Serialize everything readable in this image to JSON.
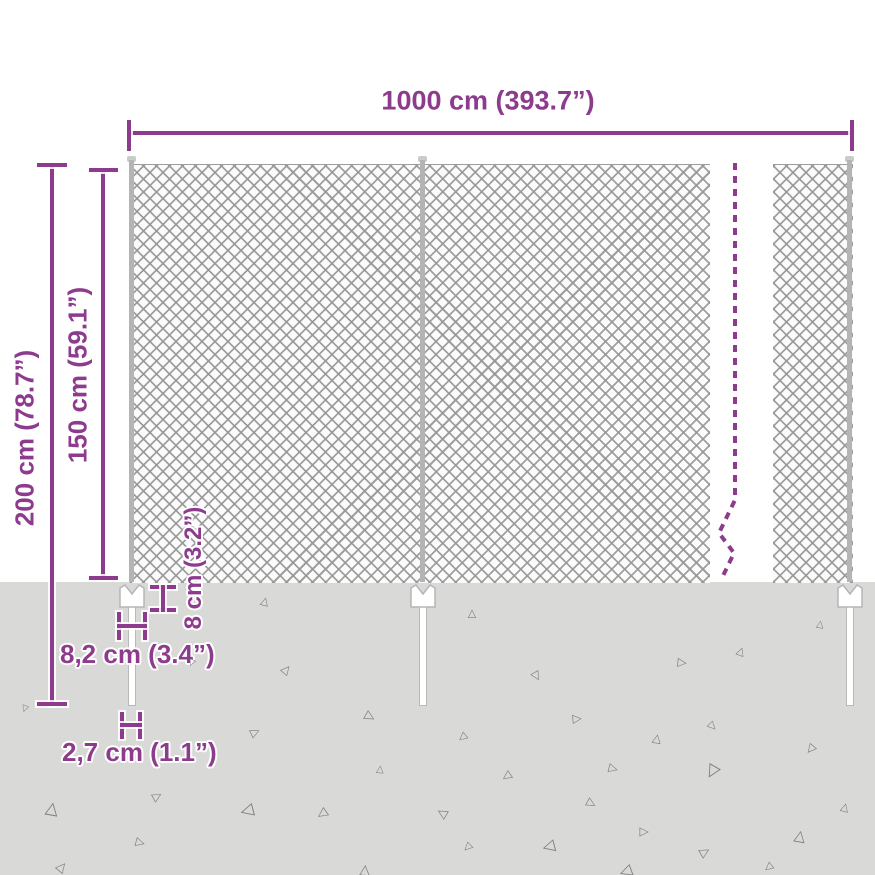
{
  "diagram": {
    "labels": {
      "total_width": "1000 cm (393.7”)",
      "total_height": "200 cm (78.7”)",
      "mesh_height": "150 cm (59.1”)",
      "anchor_height": "8 cm (3.2”)",
      "anchor_width": "8,2 cm (3.4”)",
      "spike_width": "2,7 cm (1.1”)"
    },
    "colors": {
      "accent": "#8d3b8d",
      "ground": "#d9d9d8",
      "mesh_line": "#a6a6a6",
      "post": "#b5b5b5",
      "triangle": "#7d7d7d",
      "background": "#ffffff"
    },
    "ground": {
      "triangle_glyph": "△",
      "triangles": [
        [
          265,
          601,
          11,
          15
        ],
        [
          472,
          613,
          11,
          0
        ],
        [
          820,
          625,
          10,
          10
        ],
        [
          287,
          669,
          12,
          40
        ],
        [
          537,
          677,
          12,
          150
        ],
        [
          683,
          663,
          12,
          95
        ],
        [
          741,
          651,
          11,
          20
        ],
        [
          192,
          662,
          9,
          205
        ],
        [
          370,
          717,
          13,
          120
        ],
        [
          256,
          732,
          12,
          65
        ],
        [
          578,
          719,
          12,
          85
        ],
        [
          713,
          727,
          11,
          135
        ],
        [
          462,
          738,
          11,
          230
        ],
        [
          657,
          738,
          12,
          10
        ],
        [
          380,
          770,
          10,
          5
        ],
        [
          506,
          777,
          12,
          235
        ],
        [
          614,
          769,
          12,
          105
        ],
        [
          810,
          750,
          12,
          220
        ],
        [
          712,
          772,
          17,
          210
        ],
        [
          158,
          796,
          12,
          60
        ],
        [
          52,
          809,
          17,
          10
        ],
        [
          247,
          811,
          17,
          255
        ],
        [
          322,
          814,
          13,
          235
        ],
        [
          592,
          804,
          12,
          120
        ],
        [
          442,
          813,
          13,
          300
        ],
        [
          467,
          848,
          11,
          225
        ],
        [
          548,
          847,
          16,
          255
        ],
        [
          645,
          832,
          12,
          90
        ],
        [
          141,
          843,
          12,
          105
        ],
        [
          800,
          836,
          15,
          10
        ],
        [
          705,
          852,
          13,
          60
        ],
        [
          62,
          867,
          13,
          40
        ],
        [
          365,
          870,
          14,
          5
        ],
        [
          768,
          868,
          11,
          230
        ],
        [
          625,
          872,
          16,
          250
        ],
        [
          845,
          807,
          11,
          15
        ],
        [
          25,
          708,
          9,
          200
        ]
      ]
    }
  }
}
